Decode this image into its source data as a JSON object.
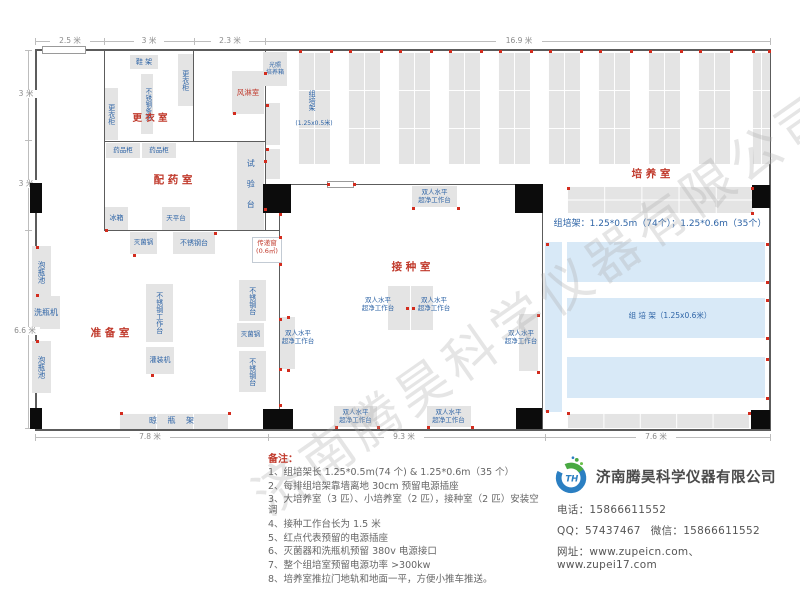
{
  "watermark": {
    "text": "济南腾昊科学仪器有限公司"
  },
  "notes": {
    "title": "备注：",
    "items": [
      "1、组培架长 1.25*0.5m(74 个) & 1.25*0.6m（35 个）",
      "2、每排组培架靠墙离地 30cm 预留电源插座",
      "3、大培养室（3 匹）、小培养室（2 匹），接种室（2 匹）安装空调",
      "4、接种工作台长为 1.5 米",
      "5、红点代表预留的电源插座",
      "6、灭菌器和洗瓶机预留 380v 电源接口",
      "7、整个组培室预留电源功率 >300kw",
      "8、培养室推拉门地轨和地面一平，方便小推车推送。"
    ]
  },
  "company": {
    "logo_text": "TH",
    "name": "济南腾昊科学仪器有限公司",
    "phone_label": "电话：",
    "phone": "15866611552",
    "qq_label": "QQ：",
    "qq": "57437467",
    "wechat_label": "微信：",
    "wechat": "15866611552",
    "web_label": "网址：",
    "websites": "www.zupeicn.com、www.zupei17.com"
  },
  "plan": {
    "walls": [
      {
        "x": 35,
        "y": 49,
        "w": 736,
        "h": 2
      },
      {
        "x": 35,
        "y": 49,
        "w": 2,
        "h": 382
      },
      {
        "x": 35,
        "y": 429,
        "w": 736,
        "h": 2
      },
      {
        "x": 769,
        "y": 49,
        "w": 2,
        "h": 382
      },
      {
        "x": 104,
        "y": 50,
        "w": 1,
        "h": 181
      },
      {
        "x": 104,
        "y": 141,
        "w": 162,
        "h": 1
      },
      {
        "x": 193,
        "y": 50,
        "w": 1,
        "h": 92
      },
      {
        "x": 265,
        "y": 50,
        "w": 1,
        "h": 181
      },
      {
        "x": 104,
        "y": 230,
        "w": 176,
        "h": 1
      },
      {
        "x": 279,
        "y": 184,
        "w": 1,
        "h": 246
      },
      {
        "x": 265,
        "y": 184,
        "w": 278,
        "h": 1
      },
      {
        "x": 542,
        "y": 184,
        "w": 1,
        "h": 246
      }
    ],
    "windows": [
      {
        "x": 42,
        "y": 46,
        "w": 44,
        "h": 8
      },
      {
        "x": 327,
        "y": 181,
        "w": 27,
        "h": 7
      }
    ],
    "doors": [
      {
        "x": 30,
        "y": 183,
        "w": 12,
        "h": 30
      },
      {
        "x": 30,
        "y": 408,
        "w": 12,
        "h": 21
      },
      {
        "x": 263,
        "y": 184,
        "w": 28,
        "h": 29
      },
      {
        "x": 515,
        "y": 184,
        "w": 28,
        "h": 29
      },
      {
        "x": 263,
        "y": 409,
        "w": 30,
        "h": 20
      },
      {
        "x": 516,
        "y": 408,
        "w": 26,
        "h": 21
      },
      {
        "x": 752,
        "y": 185,
        "w": 18,
        "h": 23
      },
      {
        "x": 751,
        "y": 410,
        "w": 19,
        "h": 19
      }
    ],
    "boxes": [
      {
        "n": "shoe-rack",
        "t": "鞋 架",
        "x": 130,
        "y": 55,
        "w": 28,
        "h": 14
      },
      {
        "n": "locker",
        "t": "更衣柜",
        "x": 178,
        "y": 54,
        "w": 15,
        "h": 52,
        "vert": 1
      },
      {
        "n": "steel-bench",
        "t": "不锈钢条凳",
        "x": 141,
        "y": 74,
        "w": 12,
        "h": 60,
        "vert": 1,
        "s": 6.5
      },
      {
        "n": "locker",
        "t": "更衣柜",
        "x": 105,
        "y": 88,
        "w": 13,
        "h": 52,
        "vert": 1
      },
      {
        "n": "air-shower",
        "t": "风淋室",
        "x": 232,
        "y": 71,
        "w": 32,
        "h": 43,
        "c": "red",
        "s": 7.5
      },
      {
        "n": "light-incubator",
        "t": "光照\n培养箱",
        "x": 263,
        "y": 52,
        "w": 24,
        "h": 34,
        "s": 6
      },
      {
        "n": "cabinet",
        "x": 266,
        "y": 103,
        "w": 14,
        "h": 42
      },
      {
        "n": "cabinet",
        "x": 266,
        "y": 149,
        "w": 14,
        "h": 30
      },
      {
        "n": "medicine-cabinet",
        "t": "药品柜",
        "x": 106,
        "y": 143,
        "w": 34,
        "h": 15,
        "s": 6.5
      },
      {
        "n": "medicine-cabinet",
        "t": "药品柜",
        "x": 142,
        "y": 143,
        "w": 34,
        "h": 15,
        "s": 6.5
      },
      {
        "n": "fridge",
        "t": "冰箱",
        "x": 105,
        "y": 207,
        "w": 23,
        "h": 23
      },
      {
        "n": "balance-table",
        "t": "天平台",
        "x": 162,
        "y": 207,
        "w": 28,
        "h": 23,
        "s": 6.5
      },
      {
        "n": "test-bench",
        "t": "试 验 台",
        "x": 237,
        "y": 142,
        "w": 27,
        "h": 88,
        "vert": 1,
        "s": 8,
        "ls": 5
      },
      {
        "n": "sterilizer",
        "t": "灭菌锅",
        "x": 130,
        "y": 232,
        "w": 27,
        "h": 22,
        "s": 6.5
      },
      {
        "n": "steel-table",
        "t": "不锈钢台",
        "x": 173,
        "y": 232,
        "w": 42,
        "h": 22,
        "s": 7
      },
      {
        "n": "soak-pool",
        "t": "泡瓶池",
        "x": 32,
        "y": 246,
        "w": 19,
        "h": 52,
        "vert": 1,
        "s": 7.5
      },
      {
        "n": "bottle-washer",
        "t": "洗瓶机",
        "x": 32,
        "y": 296,
        "w": 28,
        "h": 33,
        "s": 8
      },
      {
        "n": "soak-pool",
        "t": "泡瓶池",
        "x": 32,
        "y": 341,
        "w": 19,
        "h": 52,
        "vert": 1,
        "s": 7.5
      },
      {
        "n": "steel-workbench",
        "t": "不锈钢工作台",
        "x": 146,
        "y": 284,
        "w": 27,
        "h": 58,
        "vert": 1,
        "s": 7
      },
      {
        "n": "filling-machine",
        "t": "灌装机",
        "x": 146,
        "y": 347,
        "w": 28,
        "h": 27,
        "s": 7
      },
      {
        "n": "steel-table",
        "t": "不锈钢台",
        "x": 239,
        "y": 280,
        "w": 27,
        "h": 41,
        "vert": 1,
        "s": 7
      },
      {
        "n": "sterilizer",
        "t": "灭菌锅",
        "x": 237,
        "y": 323,
        "w": 27,
        "h": 24,
        "s": 6.5
      },
      {
        "n": "steel-table",
        "t": "不锈钢台",
        "x": 239,
        "y": 351,
        "w": 27,
        "h": 41,
        "vert": 1,
        "s": 7
      },
      {
        "n": "drying-rack",
        "t": "晾 瓶 架",
        "x": 119,
        "y": 413,
        "w": 109,
        "h": 16,
        "cw": 37,
        "ch": 16,
        "s": 8,
        "ls": 4
      },
      {
        "n": "clean-bench",
        "x": 388,
        "y": 286,
        "w": 22,
        "h": 44
      },
      {
        "n": "clean-bench",
        "x": 411,
        "y": 286,
        "w": 22,
        "h": 44
      },
      {
        "n": "clean-bench",
        "x": 412,
        "y": 186,
        "w": 45,
        "h": 21
      },
      {
        "n": "clean-bench",
        "x": 280,
        "y": 317,
        "w": 15,
        "h": 52
      },
      {
        "n": "clean-bench",
        "x": 519,
        "y": 314,
        "w": 19,
        "h": 57
      },
      {
        "n": "clean-bench",
        "x": 334,
        "y": 406,
        "w": 43,
        "h": 21
      },
      {
        "n": "clean-bench",
        "x": 427,
        "y": 406,
        "w": 44,
        "h": 21
      },
      {
        "n": "culture-rack",
        "x": 298,
        "y": 52,
        "w": 32,
        "h": 112,
        "cw": 16,
        "ch": 38
      },
      {
        "n": "culture-rack",
        "x": 348,
        "y": 52,
        "w": 32,
        "h": 112,
        "cw": 16,
        "ch": 38
      },
      {
        "n": "culture-rack",
        "x": 398,
        "y": 52,
        "w": 32,
        "h": 112,
        "cw": 16,
        "ch": 38
      },
      {
        "n": "culture-rack",
        "x": 448,
        "y": 52,
        "w": 32,
        "h": 112,
        "cw": 16,
        "ch": 38
      },
      {
        "n": "culture-rack",
        "x": 498,
        "y": 52,
        "w": 32,
        "h": 112,
        "cw": 16,
        "ch": 38
      },
      {
        "n": "culture-rack",
        "x": 548,
        "y": 52,
        "w": 32,
        "h": 112,
        "cw": 16,
        "ch": 38
      },
      {
        "n": "culture-rack",
        "x": 598,
        "y": 52,
        "w": 32,
        "h": 112,
        "cw": 16,
        "ch": 38
      },
      {
        "n": "culture-rack",
        "x": 648,
        "y": 52,
        "w": 32,
        "h": 112,
        "cw": 16,
        "ch": 38
      },
      {
        "n": "culture-rack",
        "x": 698,
        "y": 52,
        "w": 32,
        "h": 112,
        "cw": 16,
        "ch": 38
      },
      {
        "n": "culture-rack",
        "x": 752,
        "y": 52,
        "w": 18,
        "h": 112,
        "cw": 9,
        "ch": 38
      },
      {
        "n": "culture-rack",
        "x": 567,
        "y": 186,
        "w": 186,
        "h": 27,
        "cw": 37.2,
        "ch": 13.5
      },
      {
        "n": "culture-rack",
        "x": 567,
        "y": 413,
        "w": 182,
        "h": 15,
        "cw": 36.4,
        "ch": 15
      },
      {
        "n": "culture-rack",
        "fill": "b",
        "x": 545,
        "y": 242,
        "w": 17,
        "h": 170,
        "cw": 17,
        "ch": 28
      },
      {
        "n": "culture-rack",
        "fill": "b",
        "x": 567,
        "y": 242,
        "w": 198,
        "h": 40,
        "cw": 39.6,
        "ch": 20
      },
      {
        "n": "culture-rack",
        "fill": "b",
        "x": 567,
        "y": 298,
        "w": 198,
        "h": 40,
        "cw": 39.6,
        "ch": 20
      },
      {
        "n": "culture-rack",
        "fill": "b",
        "x": 567,
        "y": 357,
        "w": 198,
        "h": 41,
        "cw": 39.6,
        "ch": 20.5
      },
      {
        "n": "transfer-window",
        "fill": "w",
        "border": 1,
        "x": 252,
        "y": 237,
        "w": 30,
        "h": 26
      }
    ],
    "labels": [
      {
        "n": "room-label-dressing",
        "t": "更 衣 室",
        "x": 120,
        "y": 113,
        "w": 60,
        "c": "red",
        "s": 9.5,
        "room": 1
      },
      {
        "n": "room-label-dispensing",
        "t": "配 药 室",
        "x": 128,
        "y": 174,
        "w": 90,
        "c": "red",
        "s": 10.5,
        "room": 1
      },
      {
        "n": "room-label-preparation",
        "t": "准 备 室",
        "x": 68,
        "y": 327,
        "w": 84,
        "c": "red",
        "s": 10.5,
        "room": 1
      },
      {
        "n": "room-label-inoculation",
        "t": "接 种 室",
        "x": 368,
        "y": 261,
        "w": 86,
        "c": "red",
        "s": 10.5,
        "room": 1
      },
      {
        "n": "room-label-culture",
        "t": "培 养 室",
        "x": 608,
        "y": 168,
        "w": 86,
        "c": "red",
        "s": 10.5,
        "room": 1
      },
      {
        "n": "transfer-window-label",
        "t": "传递窗\n(0.6㎡)",
        "x": 249,
        "y": 239,
        "w": 36,
        "c": "red",
        "s": 6.5
      },
      {
        "n": "clean-bench-label",
        "t": "双人水平\n超净工作台",
        "x": 352,
        "y": 296,
        "w": 52,
        "s": 6.5
      },
      {
        "n": "clean-bench-label",
        "t": "双人水平\n超净工作台",
        "x": 408,
        "y": 296,
        "w": 52,
        "s": 6.5
      },
      {
        "n": "clean-bench-label",
        "t": "双人水平\n超净工作台",
        "x": 410,
        "y": 188,
        "w": 49,
        "s": 6.5
      },
      {
        "n": "clean-bench-label",
        "t": "双人水平\n超净工作台",
        "x": 274,
        "y": 329,
        "w": 48,
        "s": 6.5
      },
      {
        "n": "clean-bench-label",
        "t": "双人水平\n超净工作台",
        "x": 497,
        "y": 329,
        "w": 48,
        "s": 6.5
      },
      {
        "n": "clean-bench-label",
        "t": "双人水平\n超净工作台",
        "x": 331,
        "y": 408,
        "w": 49,
        "s": 6.5
      },
      {
        "n": "clean-bench-label",
        "t": "双人水平\n超净工作台",
        "x": 424,
        "y": 408,
        "w": 49,
        "s": 6.5
      },
      {
        "n": "rack-label",
        "t": "组培架",
        "x": 307,
        "y": 80,
        "h": 40,
        "vert": 1,
        "s": 7
      },
      {
        "n": "rack-size-label",
        "t": "(1.25x0.5米)",
        "x": 288,
        "y": 120,
        "w": 52,
        "s": 6
      },
      {
        "n": "rack-summary",
        "t": "组培架：1.25*0.5m（74个）；1.25*0.6m（35个）",
        "x": 550,
        "y": 219,
        "w": 220,
        "s": 9,
        "nw": 1
      },
      {
        "n": "rack-label",
        "t": "组  培  架（1.25x0.6米）",
        "x": 600,
        "y": 311,
        "w": 140,
        "s": 7.5
      }
    ],
    "dots": [
      [
        299,
        50
      ],
      [
        330,
        50
      ],
      [
        349,
        50
      ],
      [
        380,
        50
      ],
      [
        399,
        50
      ],
      [
        430,
        50
      ],
      [
        449,
        50
      ],
      [
        480,
        50
      ],
      [
        499,
        50
      ],
      [
        530,
        50
      ],
      [
        549,
        50
      ],
      [
        580,
        50
      ],
      [
        599,
        50
      ],
      [
        630,
        50
      ],
      [
        649,
        50
      ],
      [
        680,
        50
      ],
      [
        699,
        50
      ],
      [
        730,
        50
      ],
      [
        752,
        50
      ],
      [
        768,
        50
      ],
      [
        266,
        104
      ],
      [
        266,
        148
      ],
      [
        233,
        112
      ],
      [
        264,
        72
      ],
      [
        264,
        160
      ],
      [
        264,
        208
      ],
      [
        105,
        229
      ],
      [
        133,
        254
      ],
      [
        214,
        232
      ],
      [
        279,
        213
      ],
      [
        279,
        236
      ],
      [
        279,
        263
      ],
      [
        279,
        318
      ],
      [
        279,
        368
      ],
      [
        279,
        404
      ],
      [
        36,
        246
      ],
      [
        36,
        294
      ],
      [
        36,
        340
      ],
      [
        151,
        374
      ],
      [
        120,
        412
      ],
      [
        228,
        412
      ],
      [
        406,
        307
      ],
      [
        412,
        307
      ],
      [
        335,
        426
      ],
      [
        377,
        426
      ],
      [
        427,
        426
      ],
      [
        471,
        426
      ],
      [
        287,
        316
      ],
      [
        287,
        369
      ],
      [
        537,
        314
      ],
      [
        537,
        371
      ],
      [
        412,
        207
      ],
      [
        457,
        207
      ],
      [
        327,
        183
      ],
      [
        353,
        183
      ],
      [
        766,
        243
      ],
      [
        766,
        281
      ],
      [
        766,
        299
      ],
      [
        766,
        337
      ],
      [
        766,
        358
      ],
      [
        766,
        397
      ],
      [
        546,
        243
      ],
      [
        546,
        410
      ],
      [
        567,
        187
      ],
      [
        751,
        187
      ],
      [
        751,
        212
      ],
      [
        567,
        412
      ],
      [
        748,
        412
      ]
    ],
    "dimlines": [
      {
        "x": 35,
        "y": 41,
        "w": 735,
        "h": 1
      },
      {
        "x": 28,
        "y": 50,
        "w": 1,
        "h": 378
      },
      {
        "x": 35,
        "y": 437,
        "w": 735,
        "h": 1
      },
      {
        "x": 35,
        "y": 38,
        "w": 1,
        "h": 7
      },
      {
        "x": 104,
        "y": 38,
        "w": 1,
        "h": 7
      },
      {
        "x": 194,
        "y": 38,
        "w": 1,
        "h": 7
      },
      {
        "x": 265,
        "y": 38,
        "w": 1,
        "h": 7
      },
      {
        "x": 770,
        "y": 38,
        "w": 1,
        "h": 7
      },
      {
        "x": 25,
        "y": 50,
        "w": 7,
        "h": 1
      },
      {
        "x": 25,
        "y": 140,
        "w": 7,
        "h": 1
      },
      {
        "x": 25,
        "y": 230,
        "w": 7,
        "h": 1
      },
      {
        "x": 25,
        "y": 428,
        "w": 7,
        "h": 1
      },
      {
        "x": 35,
        "y": 434,
        "w": 1,
        "h": 7
      },
      {
        "x": 268,
        "y": 434,
        "w": 1,
        "h": 7
      },
      {
        "x": 545,
        "y": 434,
        "w": 1,
        "h": 7
      },
      {
        "x": 770,
        "y": 434,
        "w": 1,
        "h": 7
      }
    ],
    "dims": [
      {
        "t": "2.5 米",
        "x": 50,
        "y": 37,
        "w": 38
      },
      {
        "t": "3 米",
        "x": 134,
        "y": 37,
        "w": 28
      },
      {
        "t": "2.3 米",
        "x": 211,
        "y": 37,
        "w": 36
      },
      {
        "t": "16.9 米",
        "x": 496,
        "y": 37,
        "w": 44
      },
      {
        "t": "3 米",
        "x": 14,
        "y": 90,
        "w": 22
      },
      {
        "t": "3 米",
        "x": 14,
        "y": 180,
        "w": 22
      },
      {
        "t": "6.6 米",
        "x": 10,
        "y": 327,
        "w": 28
      },
      {
        "t": "7.8 米",
        "x": 130,
        "y": 433,
        "w": 38
      },
      {
        "t": "9.3 米",
        "x": 384,
        "y": 433,
        "w": 38
      },
      {
        "t": "7.6 米",
        "x": 636,
        "y": 433,
        "w": 38
      }
    ]
  }
}
